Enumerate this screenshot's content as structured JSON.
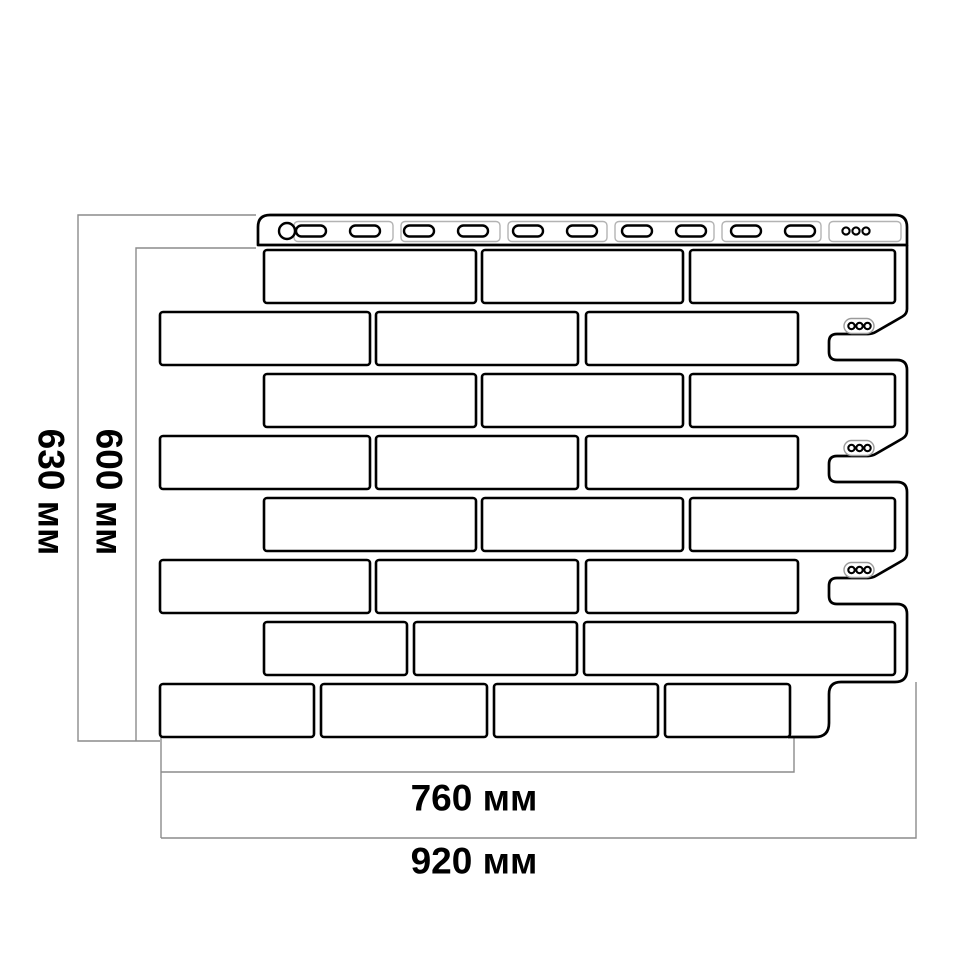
{
  "page": {
    "background": "#ffffff",
    "description": "Technical dimension drawing of a brick-pattern facade cladding panel"
  },
  "diagram": {
    "type": "technical-drawing",
    "labels": {
      "overall_height": "630 мм",
      "face_height": "600 мм",
      "face_width": "760 мм",
      "overall_width": "920 мм"
    },
    "units": "мм",
    "values": {
      "overall_height": 630,
      "face_height": 600,
      "face_width": 760,
      "overall_width": 920
    },
    "colors": {
      "outline": "#000000",
      "dimension_line": "#8c8c8c",
      "detail_line": "#b3b3b3",
      "text": "#000000",
      "background": "#ffffff"
    }
  }
}
